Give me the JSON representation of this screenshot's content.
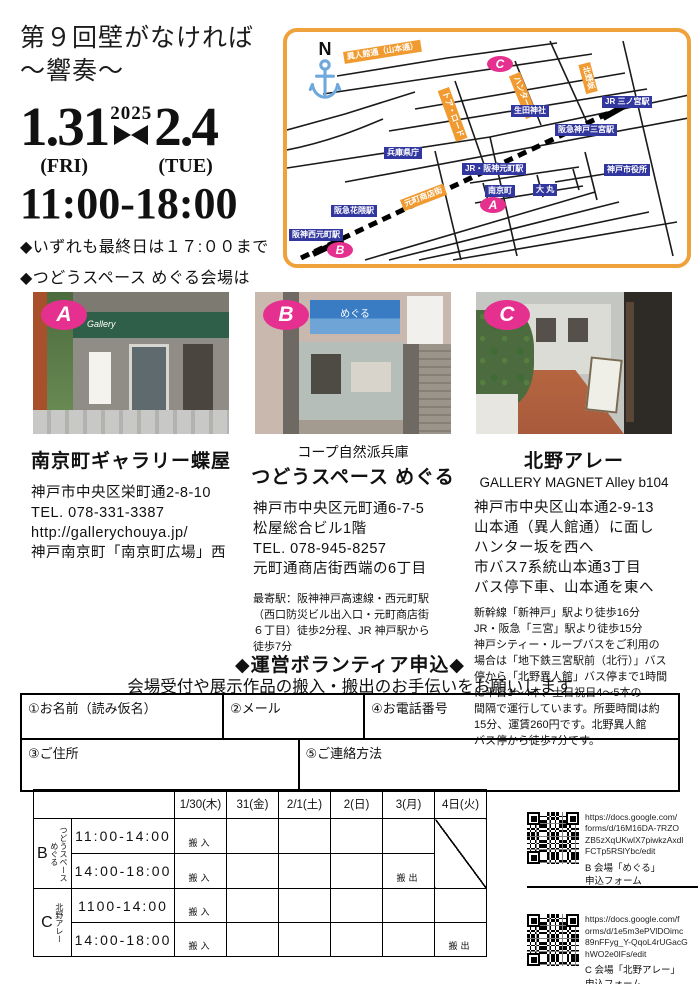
{
  "header": {
    "title_line1": "第９回壁がなければ",
    "title_line2": "～響奏～",
    "date_start": "1.31",
    "day_start": "(FRI)",
    "year": "2025",
    "date_end": "2.4",
    "day_end": "(TUE)",
    "time": "11:00-18:00",
    "note1": "◆いずれも最終日は１７:００まで",
    "note2": "◆つどうスペース めぐる会場は",
    "note3": "２月３日（月）まで"
  },
  "map": {
    "compass": "N",
    "labels": {
      "ijinkan": "異人館通（山本通）",
      "kitanozaka": "北野坂",
      "hunterzaka": "ハンター坂",
      "tor_road": "トア・ロード",
      "jr_sannomiya": "JR 三ノ宮駅",
      "ikuta": "生田神社",
      "hankyu_sannomiya": "阪急神戸三宮駅",
      "kencho": "兵庫県庁",
      "jr_motomachi": "JR・阪神元町駅",
      "cityhall": "神戸市役所",
      "nankinmachi": "南京町",
      "daimaru": "大 丸",
      "hanakuma": "阪急花隈駅",
      "motomachi_st": "元町商店街",
      "nishimotomachi": "阪神西元町駅"
    },
    "markers": {
      "a": "A",
      "b": "B",
      "c": "C"
    }
  },
  "venues": [
    {
      "badge": "A",
      "name": "南京町ギャラリー蝶屋",
      "photo_sign": "Gallery",
      "address": [
        "神戸市中央区栄町通2-8-10",
        "TEL.  078-331-3387",
        "http://gallerychouya.jp/",
        "神戸南京町「南京町広場」西"
      ]
    },
    {
      "badge": "B",
      "org": "コープ自然派兵庫",
      "name": "つどうスペース めぐる",
      "photo_sign": "めぐる",
      "address": [
        "神戸市中央区元町通6-7-5",
        "松屋総合ビル1階",
        "TEL. 078-945-8257",
        "元町通商店街西端の6丁目"
      ],
      "note": [
        "最寄駅：阪神神戸高速線・西元町駅",
        "（西口防災ビル出入口・元町商店街",
        "６丁目）徒歩2分程、JR 神戸駅から",
        "徒歩7分"
      ]
    },
    {
      "badge": "C",
      "name": "北野アレー",
      "sub": "GALLERY MAGNET Alley b104",
      "address": [
        "神戸市中央区山本通2-9-13",
        "山本通（異人館通）に面し",
        "ハンター坂を西へ",
        "市バス7系統山本通3丁目",
        "バス停下車、山本通を東へ"
      ],
      "note": [
        "新幹線「新神戸」駅より徒歩16分",
        "JR・阪急「三宮」駅より徒歩15分",
        "神戸シティー・ループバスをご利用の",
        "場合は「地下鉄三宮駅前（北行）」バス",
        "停から「北野異人館」バス停まで1時間",
        "に平日3～4本、土日祝日4～5本の",
        "間隔で運行しています。所要時間は約",
        "15分、運賃260円です。北野異人館",
        "バス停から徒歩7分です。"
      ]
    }
  ],
  "volunteer": {
    "heading": "◆運営ボランティア申込◆",
    "subtitle": "会場受付や展示作品の搬入・搬出のお手伝いをお願いします",
    "fields": {
      "name": "①お名前（読み仮名）",
      "email": "②メール",
      "phone": "④お電話番号",
      "address": "③ご住所",
      "contact": "⑤ご連絡方法"
    }
  },
  "schedule": {
    "dates": [
      "1/30(木)",
      "31(金)",
      "2/1(土)",
      "2(日)",
      "3(月)",
      "4日(火)"
    ],
    "groups": [
      {
        "letter": "B",
        "vlabel1": "つどうスペース",
        "vlabel2": "めぐる",
        "rows": [
          {
            "time": "11:00-14:00",
            "cells": [
              "搬入",
              "",
              "",
              "",
              ""
            ]
          },
          {
            "time": "14:00-18:00",
            "cells": [
              "搬入",
              "",
              "",
              "",
              "搬出"
            ]
          }
        ]
      },
      {
        "letter": "C",
        "vlabel1": "北野アレー",
        "rows": [
          {
            "time": "1100-14:00",
            "cells": [
              "搬入",
              "",
              "",
              "",
              "",
              ""
            ]
          },
          {
            "time": "14:00-18:00",
            "cells": [
              "搬入",
              "",
              "",
              "",
              "",
              "搬出"
            ]
          }
        ]
      }
    ]
  },
  "qr": [
    {
      "url1": "https://docs.google.com/",
      "url2": "forms/d/16M16DA-7RZO",
      "url3": "ZB5zXqUKwlX7piwkzAxdl",
      "url4": "FCTp5RSlYbc/edit",
      "cap1": "B 会場「めぐる」",
      "cap2": "申込フォーム"
    },
    {
      "url1": "https://docs.google.com/f",
      "url2": "orms/d/1e5m3ePVlDOimc",
      "url3": "89nFFyg_Y-QqoL4rUGacG",
      "url4": "hWO2e0IFs/edit",
      "cap1": "C 会場「北野アレー」",
      "cap2": "申込フォーム"
    }
  ]
}
